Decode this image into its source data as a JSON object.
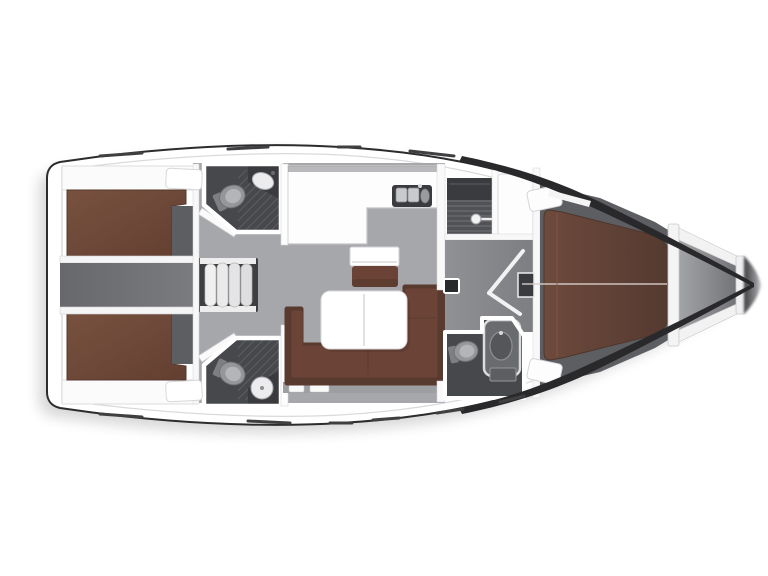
{
  "figure": {
    "kind": "sailing-yacht-interior-floor-plan",
    "orientation": "bow-right-stern-left",
    "background": "#ffffff"
  },
  "colors": {
    "hull_outline": "#2c2c2e",
    "hull_band": "#29292b",
    "deck_white": "#ffffff",
    "wall_white": "#f8f8f9",
    "wall_edge": "#cfcfd1",
    "saloon_floor": "#a6a7aa",
    "corridor_gray": "#6f7074",
    "fwd_corridor_gray": "#898a8e",
    "cabin_floor_dark": "#5d5e62",
    "head_floor": "#47484c",
    "head_hatch": "#5a5b5f",
    "berth_brown": "#6f4a3b",
    "berth_brown_dark": "#5c3d31",
    "vberth_brown": "#64433a",
    "sofa_brown": "#6c4437",
    "sofa_brown_dark": "#593a2e",
    "seat_brown": "#6b4336",
    "table_white": "#ffffff",
    "fixture_light": "#ececee",
    "fixture_mid": "#95969a",
    "fixture_dark": "#3a3b3e",
    "steps_well": "#3e3f42",
    "step_tread": "#e9e9ea",
    "bow_floor_light": "#a3a4a7",
    "bow_floor_dark": "#6c6d71",
    "shadow": "#000000"
  },
  "regions": [
    {
      "name": "aft-cabin-port",
      "surface": "double-berth"
    },
    {
      "name": "aft-cabin-starboard",
      "surface": "double-berth"
    },
    {
      "name": "engine-corridor",
      "surface": "floor"
    },
    {
      "name": "companionway-steps",
      "treads": 4
    },
    {
      "name": "aft-head-port",
      "fixtures": [
        "toilet",
        "sink"
      ]
    },
    {
      "name": "aft-head-starboard",
      "fixtures": [
        "toilet",
        "sink"
      ]
    },
    {
      "name": "galley",
      "fixtures": [
        "double-sink",
        "stove"
      ]
    },
    {
      "name": "nav-station",
      "fixtures": [
        "chart-table",
        "seat"
      ]
    },
    {
      "name": "saloon",
      "fixtures": [
        "table",
        "u-sofa"
      ]
    },
    {
      "name": "forward-head",
      "fixtures": [
        "shower",
        "toilet",
        "sink"
      ]
    },
    {
      "name": "forward-cabin",
      "surface": "v-berth"
    },
    {
      "name": "bow-anchor-locker",
      "surface": "locker"
    }
  ]
}
